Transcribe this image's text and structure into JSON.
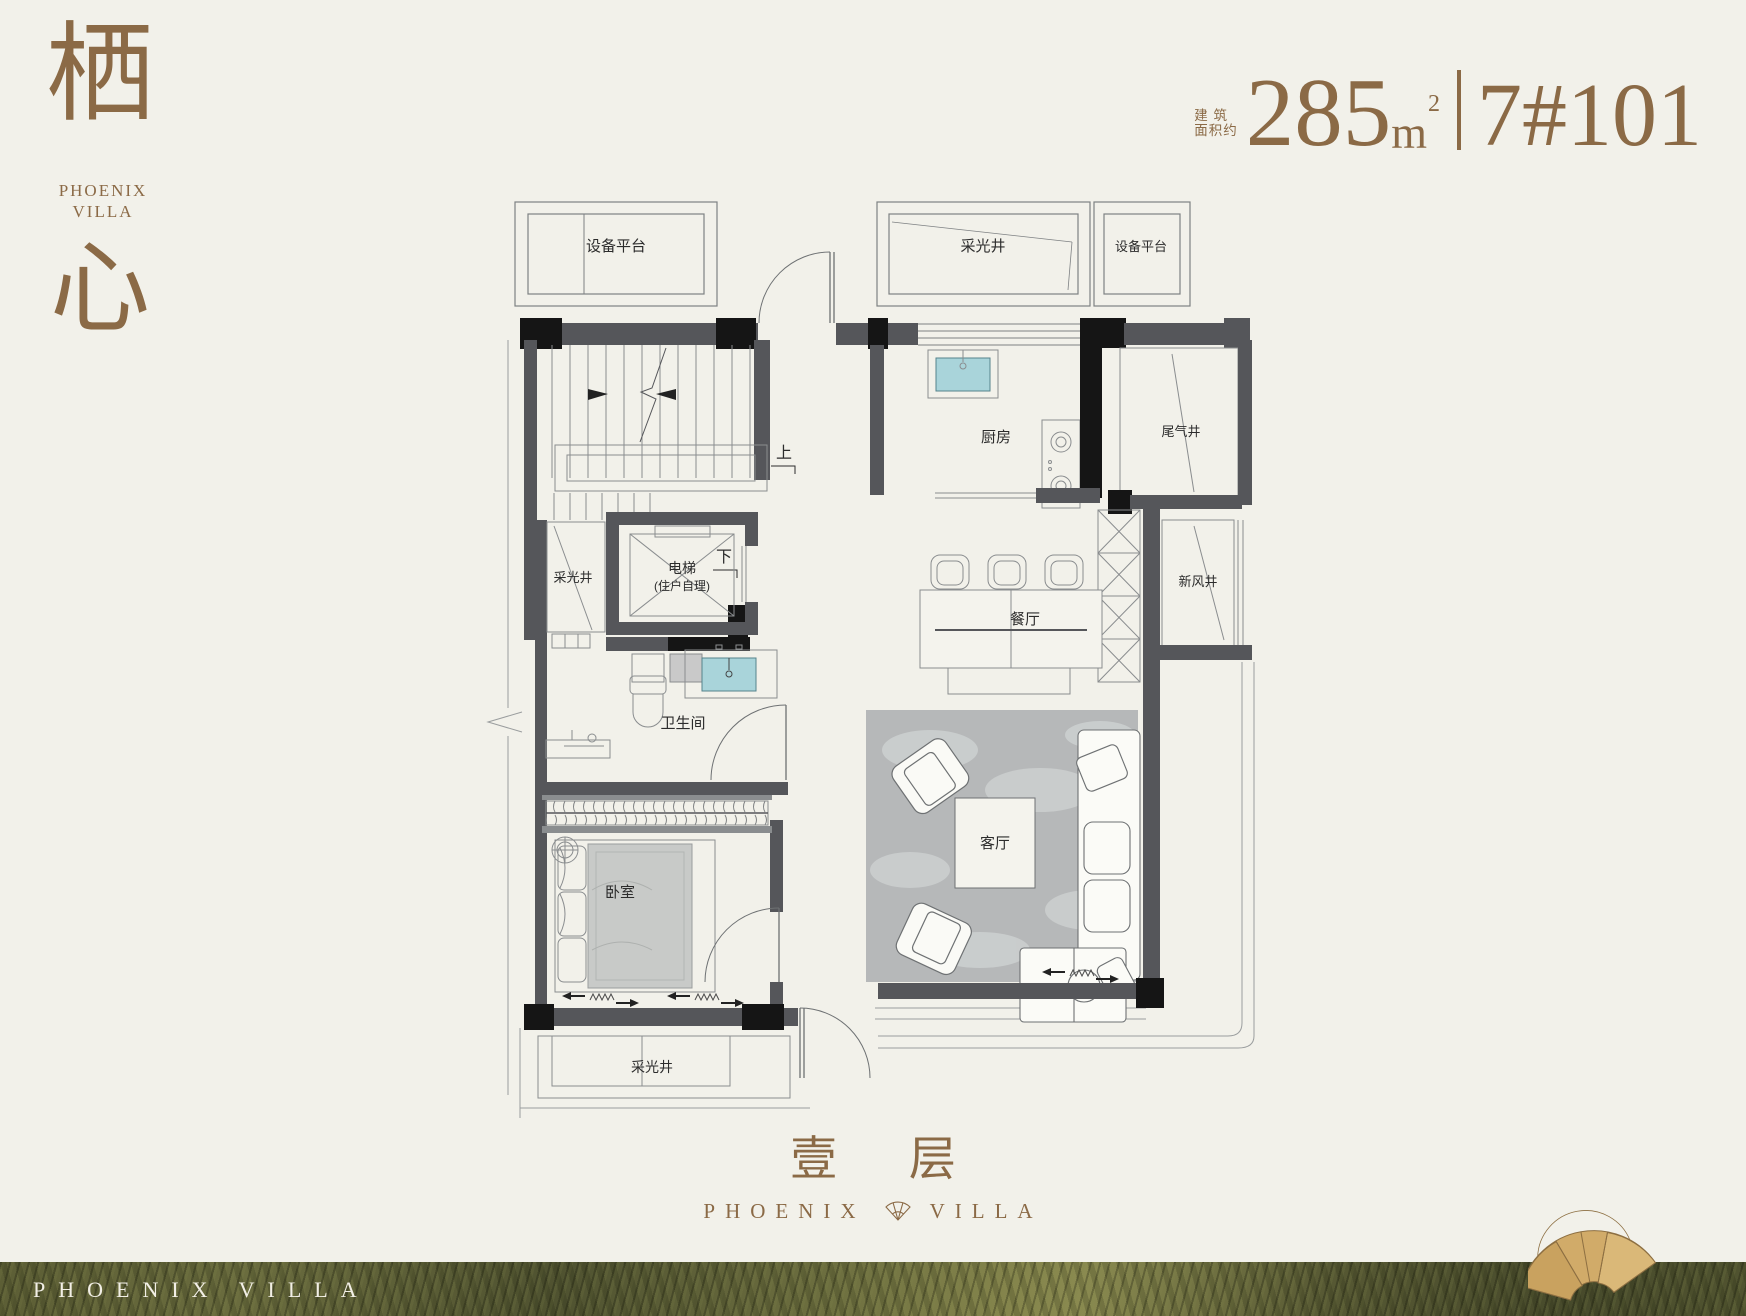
{
  "logo": {
    "hanzi_top": "栖",
    "brand_line1": "PHOENIX",
    "brand_line2": "VILLA",
    "hanzi_bottom": "心"
  },
  "header": {
    "area_label_line1": "建 筑",
    "area_label_line2": "面积约",
    "area_value": "285",
    "area_unit": "m",
    "area_exponent": "2",
    "unit_number": "7#101"
  },
  "plan": {
    "labels": {
      "equip_platform_left": "设备平台",
      "light_well_top": "采光井",
      "equip_platform_right": "设备平台",
      "stair_up": "上",
      "stair_down": "下",
      "light_well_left": "采光井",
      "elevator_line1": "电梯",
      "elevator_line2": "(住户自理)",
      "bathroom": "卫生间",
      "bedroom": "卧室",
      "light_well_bottom": "采光井",
      "kitchen": "厨房",
      "exhaust_shaft": "尾气井",
      "fresh_air_shaft": "新风井",
      "dining": "餐厅",
      "living": "客厅"
    }
  },
  "footer": {
    "floor_label": "壹 层",
    "brand_left": "PHOENIX",
    "brand_right": "VILLA"
  },
  "strip": {
    "brand_text": "PHOENIX VILLA"
  },
  "colors": {
    "background": "#f2f1ea",
    "accent_brown": "#8b6a46",
    "wall_gray": "#55565a",
    "wall_black": "#151515",
    "sink_teal": "#a9d4da",
    "rug_gray": "#b6b8b9",
    "strip_olive": "#5c5e35",
    "fan_gold": "#d1ab69",
    "strip_text_white": "#f2efe6"
  }
}
